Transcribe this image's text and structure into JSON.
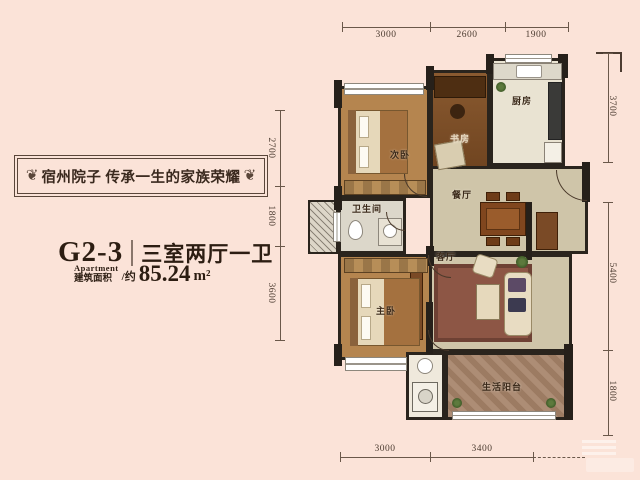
{
  "page": {
    "background": "#fbe3d8"
  },
  "brand": {
    "slogan": "宿州院子 传承一生的家族荣耀"
  },
  "unit": {
    "code": "G2-3",
    "layout": "三室两厅一卫",
    "apartment_label": "Apartment",
    "area_label": "建筑面积",
    "approx_label": "/约",
    "area_value": "85.24",
    "area_unit": "m²"
  },
  "rooms": {
    "kitchen": "厨房",
    "study": "书房",
    "bedroom2": "次卧",
    "bathroom": "卫生间",
    "dining": "餐厅",
    "living": "客厅",
    "master": "主卧",
    "balcony": "生活阳台"
  },
  "dimensions": {
    "top": [
      "3000",
      "2600",
      "1900"
    ],
    "bottom": [
      "3000",
      "3400"
    ],
    "left": [
      "2700",
      "1800",
      "3600"
    ],
    "right": [
      "3700",
      "5400",
      "1800"
    ]
  },
  "colors": {
    "wall": "#2a241d",
    "wood_floor": "#b5854f",
    "tile_floor": "#cfc5a9",
    "rug": "#8d5645",
    "background": "#fbe3d8"
  }
}
